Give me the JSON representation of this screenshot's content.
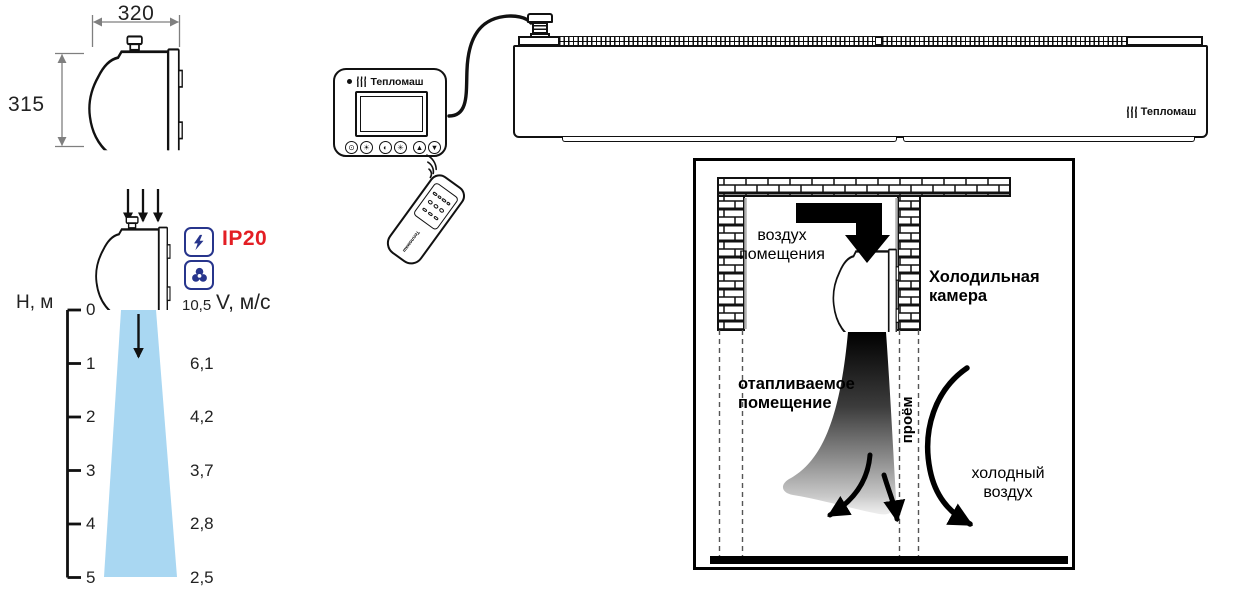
{
  "colors": {
    "ip_red": "#e31e24",
    "badge_blue": "#27358c",
    "jet_blue": "#a9d7f2",
    "dim_gray": "#7f7f7f"
  },
  "dimension_drawing": {
    "width_mm": "320",
    "height_mm": "315"
  },
  "airflow_chart": {
    "type": "profile",
    "height_axis_label": "H, м",
    "velocity_axis_label": "V, м/с",
    "ip_rating": "IP20",
    "ticks": [
      {
        "h": "0",
        "v": "10,5"
      },
      {
        "h": "1",
        "v": "6,1"
      },
      {
        "h": "2",
        "v": "4,2"
      },
      {
        "h": "3",
        "v": "3,7"
      },
      {
        "h": "4",
        "v": "2,8"
      },
      {
        "h": "5",
        "v": "2,5"
      }
    ]
  },
  "controller": {
    "brand": "Тепломаш",
    "button_icons": [
      "⊙",
      "☀",
      "◐",
      "✳",
      "▲",
      "▼"
    ]
  },
  "remote": {
    "brand": "Тепломаш"
  },
  "curtain_unit": {
    "brand": "Тепломаш"
  },
  "installation_schematic": {
    "room_air": "воздух\nпомещения",
    "cold_chamber": "Холодильная\nкамера",
    "heated_room": "отапливаемое\nпомещение",
    "opening": "проём",
    "cold_air": "холодный\nвоздух"
  }
}
